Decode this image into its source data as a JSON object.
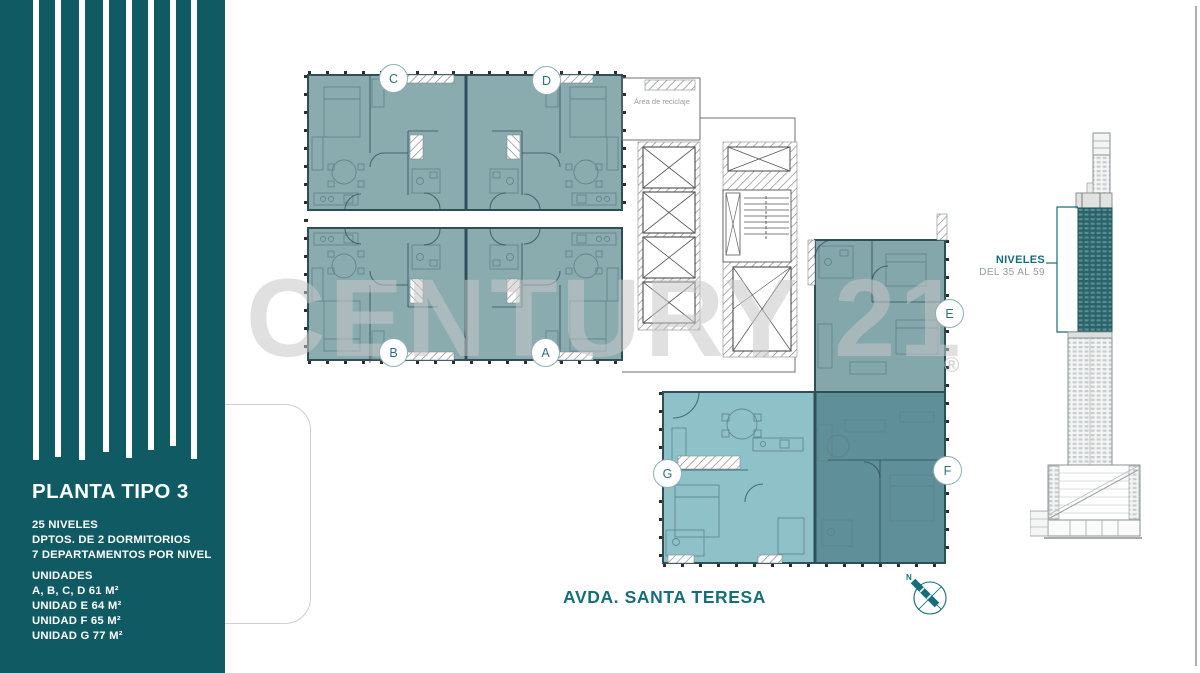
{
  "sidebar": {
    "title": "PLANTA TIPO 3",
    "specs": [
      "25 NIVELES",
      "DPTOS. DE 2 DORMITORIOS",
      "7 DEPARTAMENTOS POR NIVEL"
    ],
    "unidades_heading": "UNIDADES",
    "unidades": [
      "A, B, C, D 61 M²",
      "UNIDAD E 64 M²",
      "UNIDAD F 65 M²",
      "UNIDAD G 77 M²"
    ]
  },
  "plan": {
    "units": {
      "a": "A",
      "b": "B",
      "c": "C",
      "d": "D",
      "e": "E",
      "f": "F",
      "g": "G"
    },
    "recycle_room_label": "Área de reciclaje",
    "street_label": "AVDA. SANTA TERESA",
    "compass_north_label": "N"
  },
  "elevation": {
    "niveles_label": "NIVELES",
    "range_label": "DEL 35 AL 59"
  },
  "watermark": {
    "text": "CENTURY 21",
    "registered_mark": "®"
  },
  "colors": {
    "sidebar_teal": "#0f5a63",
    "unit_std": "#8aacaf",
    "unit_e": "#83a7ab",
    "unit_f": "#5f8f99",
    "unit_g": "#8fc2c8",
    "wall": "#2e4f58",
    "accent": "#156e7a",
    "watermark": "#c7c7c7",
    "tower_teal": "#2a646b"
  }
}
